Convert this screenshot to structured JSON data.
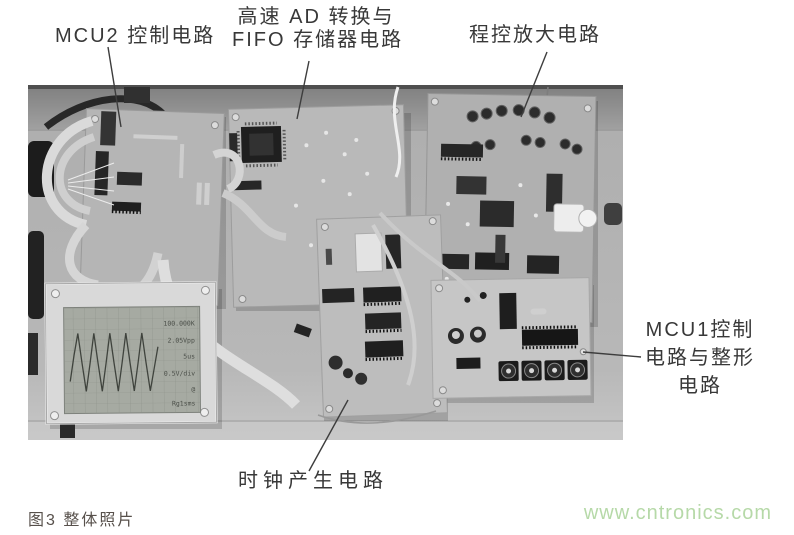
{
  "annotations": {
    "mcu2": "MCU2 控制电路",
    "ad_fifo_line1": "高速 AD 转换与",
    "ad_fifo_line2": "FIFO 存储器电路",
    "prog_amp": "程控放大电路",
    "mcu1_line1": "MCU1控制",
    "mcu1_line2": "电路与整形",
    "mcu1_line3": "电路",
    "clock": "时钟产生电路"
  },
  "photo": {
    "lcd_readouts": [
      "100.000K",
      "2.05Vpp",
      "5us",
      "0.5V/div",
      "@",
      "Rg1sms"
    ]
  },
  "figure": {
    "caption": "图3 整体照片",
    "watermark": "www.cntronics.com"
  },
  "colors": {
    "label_text": "#383838",
    "caption_text": "#57504b",
    "watermark_green": "#b6d9a8",
    "photo_background": "#b3b3b3"
  }
}
